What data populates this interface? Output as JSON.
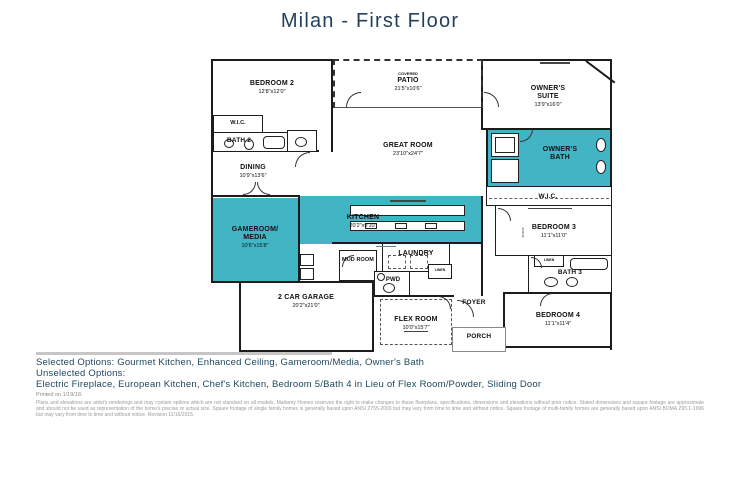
{
  "title": "Milan - First Floor",
  "colors": {
    "accent_teal": "#41b5c4",
    "title_navy": "#24405d",
    "options_text": "#20485e"
  },
  "rooms": {
    "bedroom2": {
      "name": "BEDROOM 2",
      "dims": "12'8\"x12'0\""
    },
    "wic2": {
      "name": "W.I.C."
    },
    "bath2": {
      "name": "BATH 2"
    },
    "patio": {
      "sub": "COVERED",
      "name": "PATIO",
      "dims": "21'5\"x10'6\""
    },
    "owners_suite": {
      "name": "OWNER'S SUITE",
      "dims": "13'9\"x16'0\""
    },
    "great_room": {
      "name": "GREAT ROOM",
      "dims": "23'10\"x24'7\""
    },
    "dining": {
      "name": "DINING",
      "dims": "10'9\"x13'6\""
    },
    "owners_bath": {
      "name": "OWNER'S BATH"
    },
    "owners_wic": {
      "name": "W.I.C."
    },
    "gameroom": {
      "name": "GAMEROOM/ MEDIA",
      "dims": "10'6\"x15'8\""
    },
    "kitchen": {
      "name": "KITCHEN",
      "dims": "20'2\"x9'10\""
    },
    "mud_room": {
      "name": "MUD ROOM"
    },
    "laundry": {
      "name": "LAUNDRY"
    },
    "pwd": {
      "name": "PWD"
    },
    "linen": {
      "name": "LINEN"
    },
    "bedroom3": {
      "name": "BEDROOM 3",
      "dims": "11'1\"x11'0\""
    },
    "bath3": {
      "name": "BATH 3"
    },
    "bedroom4": {
      "name": "BEDROOM 4",
      "dims": "11'1\"x11'4\""
    },
    "foyer": {
      "name": "FOYER"
    },
    "porch": {
      "name": "PORCH"
    },
    "flex": {
      "name": "FLEX ROOM",
      "dims": "10'0\"x15'7\""
    },
    "garage": {
      "name": "2 CAR GARAGE",
      "dims": "20'2\"x21'0\""
    }
  },
  "options": {
    "selected": "Selected Options: Gourmet Kitchen, Enhanced Ceiling, Gameroom/Media, Owner's Bath",
    "unselected_heading": "Unselected Options:",
    "unselected": "Electric Fireplace, European Kitchen, Chef's Kitchen, Bedroom 5/Bath 4 in Lieu of Flex Room/Powder, Sliding Door",
    "printed": "Printed on 1/19/18."
  },
  "disclaimer": "Plans and elevations are artist's renderings and may contain options which are not standard on all models. Mattamy Homes reserves the right to make changes to these floorplans, specifications, dimensions and elevations without prior notice. Stated dimensions and square footage are approximate and should not be used as representation of the home's precise or actual size. Square footage of single family homes is generally based upon ANSI Z765-2003 but may vary from time to time and without notice. Square footage of multi-family homes are generally based upon ANSI BOMA Z65.1-1996 but may vary from time to time and without notice. Revision 11/16/2015."
}
